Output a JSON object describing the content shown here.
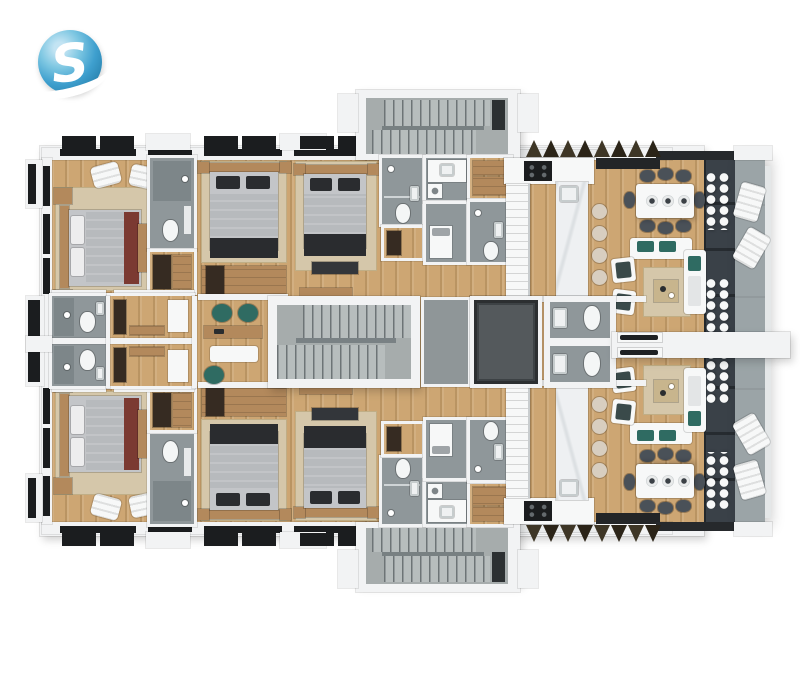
{
  "logo": {
    "letter": "S"
  },
  "palette": {
    "wall": "#f2f3f4",
    "wood": "#cda673",
    "bath": "#8f979a",
    "bathdark": "#7d8689",
    "concrete": "#a6acac",
    "tread": "#b7bdbd",
    "treadline": "#6d7476",
    "dark": "#1b1d1f",
    "glass": "#3a4148",
    "glassline": "#262b30",
    "balcony": "#9ba4a7",
    "rail": "#e4e7e8",
    "teal": "#2f6b62",
    "maroon": "#7b3a32",
    "rug": "#d5c7aa",
    "rugdark": "#c0ae86",
    "furnwood": "#b3895c",
    "wardrobe": "#362b22",
    "bed": "#c3c5c8",
    "duvet": "#b7babd",
    "blanket": "#2a2c2f",
    "chair": "#4a5158",
    "stool": "#d8cec0",
    "marble": "#eef0f2",
    "shaft": "#54595c",
    "lobby": "#8f9698",
    "white": "#f7f8f8",
    "accent": "#3e9fce"
  }
}
